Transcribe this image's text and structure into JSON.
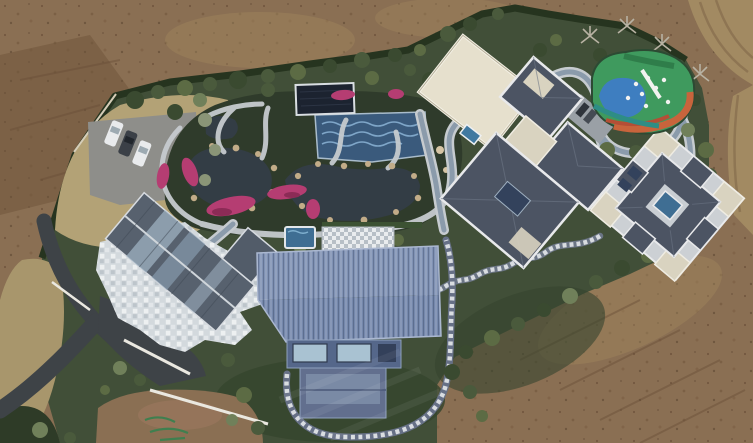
{
  "scene": {
    "type": "aerial-drone-photograph",
    "subject": "Top-down aerial drone view of a private landscaped estate compound with ornamental water garden, five buildings, a multicolor playground, parked cars and winding paths, surrounded by graded bare earth",
    "view": "nadir top-down",
    "text_visible": "none"
  },
  "palette": {
    "dirt": "#8a6f53",
    "dirt_dark": "#6e5339",
    "dirt_light": "#a2895f",
    "dirt_road": "#a28a62",
    "dry_grass": "#b3a276",
    "dry_grass2": "#a8966c",
    "lawn": "#414f38",
    "lawn_dark": "#36452e",
    "garden_bed": "#2f3b2b",
    "hedge": "#26341f",
    "pond_water": "#333d45",
    "pool_tile_blue": "#3a5a7c",
    "pool_cover": "#1c2330",
    "spa_blue": "#3f6e93",
    "path_gray": "#c6cbcf",
    "path_core": "#8b9bab",
    "stone_white": "#d3d9dd",
    "asphalt": "#3e4347",
    "wall_white": "#eae8e0",
    "roof_slate": "#4c5463",
    "roof_trim": "#e8e9eb",
    "roof_cream": "#d9d3c0",
    "roof_metal_blue": "#8092b4",
    "roof_metal_blue_dark": "#7588ac",
    "deck_blue": "#55678a",
    "window_glass": "#a9c2d2",
    "west_roof": "#57616e",
    "skylight": "#9db1c2",
    "azalea_pink": "#b53d72",
    "azalea_dark": "#8c2b56",
    "rock_tan": "#c2ac88",
    "play_green": "#3f9a5e",
    "play_blue": "#3e7ec0",
    "play_orange": "#c8643c",
    "play_teal": "#2e8d85",
    "play_white": "#f2f2f0",
    "car_white": "#e9ebed",
    "car_dark": "#3b4047",
    "parking_gray": "#8e8e8a"
  },
  "inventory": {
    "buildings": [
      {
        "name": "west-house",
        "roof": "gray gable roof with glass skylight strips",
        "surround": "white stone mosaic patio"
      },
      {
        "name": "barn-hall",
        "roof": "ribbed slate-blue standing-seam metal roof",
        "feature": "south window deck and looping stone path"
      },
      {
        "name": "central-villa",
        "roof": "dark slate hip roofs with white trim and cream flat decks"
      },
      {
        "name": "east-villa",
        "roof": "dark slate pinwheel roof, cream corner pavilions",
        "feature": "central courtyard pool"
      },
      {
        "name": "garden-pavilion",
        "roof": "flat cream roof"
      }
    ],
    "vehicles": [
      {
        "name": "car",
        "color": "white"
      },
      {
        "name": "car",
        "color": "dark-gray"
      },
      {
        "name": "car",
        "color": "white"
      }
    ],
    "water_features": [
      "west ornamental pond",
      "east ornamental pond",
      "blue tiled pool",
      "covered dark pool",
      "spa pool",
      "courtyard pool"
    ],
    "recreation": [
      "playground with green, blue and orange rubber surface"
    ],
    "circulation": [
      "asphalt driveway",
      "gravel parking pad",
      "gray loop path",
      "winding stone stair path",
      "patio walkways",
      "dirt road"
    ]
  }
}
